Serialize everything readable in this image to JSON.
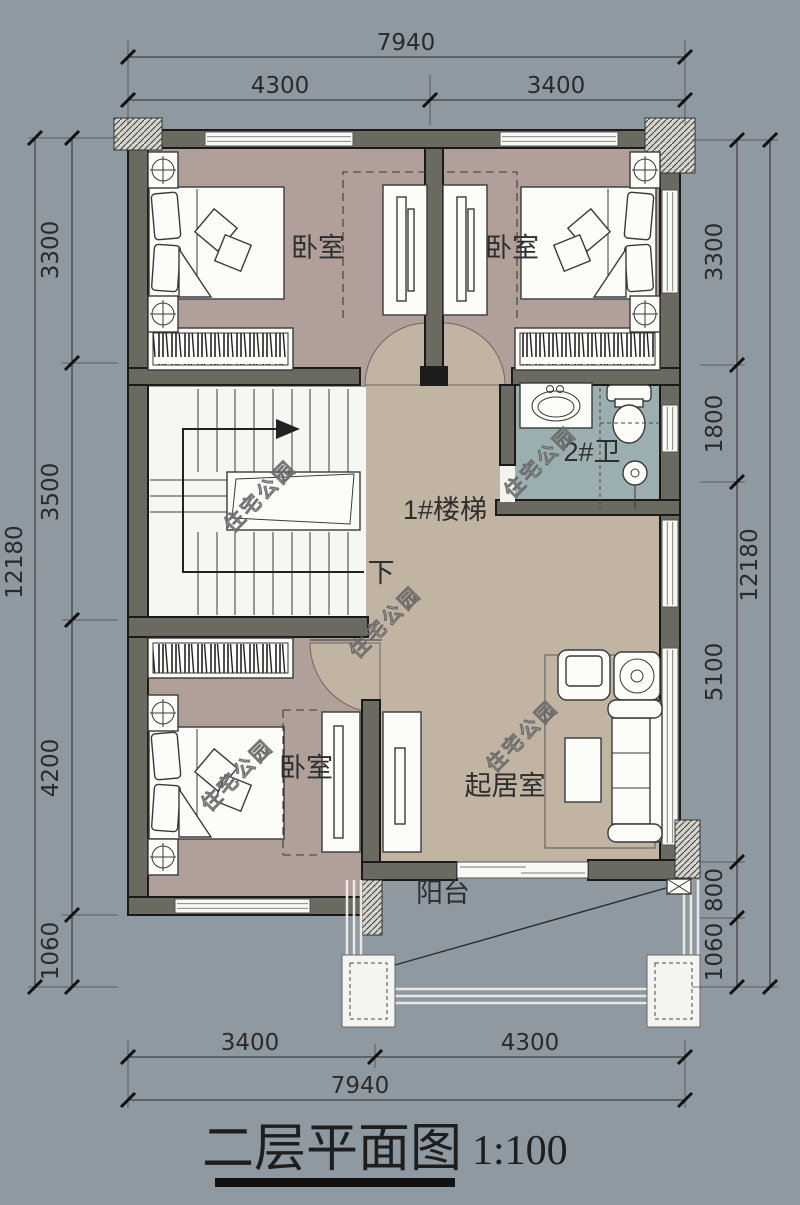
{
  "title": {
    "name": "二层平面图",
    "scale": "1:100"
  },
  "watermark": {
    "text": "住宅公园"
  },
  "rooms": {
    "bedroom_tl": {
      "label": "卧室"
    },
    "bedroom_tr": {
      "label": "卧室"
    },
    "bedroom_b": {
      "label": "卧室"
    },
    "stair": {
      "label": "1#楼梯",
      "down": "下"
    },
    "bath": {
      "label": "2#卫"
    },
    "living": {
      "label": "起居室"
    },
    "balcony": {
      "label": "阳台"
    }
  },
  "dims": {
    "top": {
      "total": "7940",
      "seg1": "4300",
      "seg2": "3400"
    },
    "bottom": {
      "total": "7940",
      "seg1": "3400",
      "seg2": "4300"
    },
    "left": {
      "total": "12180",
      "seg1": "3300",
      "seg2": "3500",
      "seg3": "4200",
      "seg4": "1060"
    },
    "right": {
      "total": "12180",
      "seg1": "3300",
      "seg2": "1800",
      "seg3": "5100",
      "seg4": "800",
      "seg5": "1060"
    }
  },
  "colors": {
    "bg": "#8f99a1",
    "floor-bedroom": "#b1a09a",
    "floor-hall": "#c2b4a2",
    "floor-bath": "#9cafb0",
    "floor-stair": "#f6f6f2",
    "wall-fill": "#6b6a60",
    "wall-edge": "#1a1a1a",
    "furniture": "#fcfcf9",
    "line": "#3a3a3a",
    "dim": "#2b2b2b",
    "watermark-fill": "#efefe9"
  }
}
